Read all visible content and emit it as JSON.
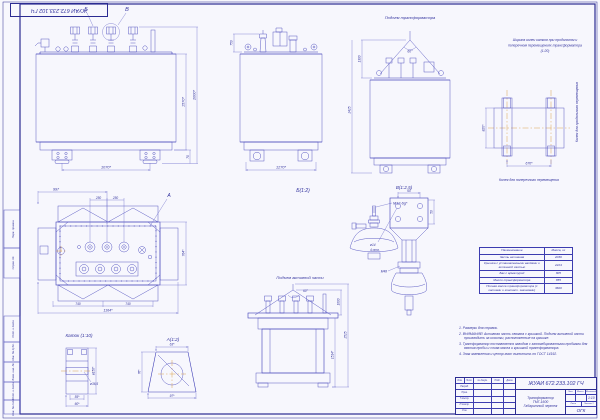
{
  "colors": {
    "paper": "#f7f7fd",
    "line": "#3d3db6",
    "dim_line": "#7070cc",
    "text": "#32329e",
    "center_line": "#d89a3e",
    "frame": "#2b2b92"
  },
  "stamp": {
    "doc_number_top": "ЖУАИ 672.233.102 ГЧ"
  },
  "labels": {
    "marker_b": "Б",
    "marker_v": "В",
    "marker_a": "А",
    "detail_b": "Б(1:2)",
    "detail_v": "В(1:2,5)",
    "detail_a": "А(1:2)",
    "roller": "Каток  (1:10)",
    "lift_transformer": "Подъем трансформатора",
    "lift_active": "Подъем активной части",
    "track_note_1": "Ширина колеи катков при продольном и",
    "track_note_2": "поперечном перемещениях трансформатора",
    "track_note_3": "(1:20)",
    "track_transverse": "Колея для поперечного перемещения",
    "track_longitudinal": "Колея для продольного перемещения"
  },
  "dims": {
    "front_width": "1070*",
    "front_h1": "1570*",
    "front_h2": "2000*",
    "front_base": "70",
    "side_width": "1270*",
    "side_bushing_h": "750",
    "lift_h1": "1300",
    "lift_h2": "2425",
    "lift_angle": "60°",
    "plan_w1": "997",
    "plan_250a": "250",
    "plan_250b": "250",
    "plan_h": "764*",
    "plan_740a": "740",
    "plan_740b": "740",
    "plan_total": "1164*",
    "track_h": "820*",
    "track_w": "670*",
    "roller_d": "ø150*",
    "roller_axle": "ø36,5",
    "roller_w1": "55*",
    "roller_w2": "60*",
    "a_top": "63*",
    "a_side": "76*",
    "a_bottom": "97*",
    "thread": "М12-6g*",
    "v_top": "60",
    "v_side": "50",
    "v_holes_d": "ø14",
    "v_holes_n": "4 отв.",
    "v_thread": "М48",
    "active_h1": "1000",
    "active_h2": "2525",
    "active_h3": "1514*",
    "sling_angle": "60°"
  },
  "mass_table": {
    "col_name": "Наименование",
    "col_mass": "Масса, кг",
    "rows": [
      {
        "name": "Часть активная",
        "mass": "2036"
      },
      {
        "name": "Крышка с установленными вводами и активной частью",
        "mass": "2224"
      },
      {
        "name": "Бак с арматурой",
        "mass": "805"
      },
      {
        "name": "Масло трансформатора",
        "mass": "855"
      },
      {
        "name": "Полная масса трансформатора (с катками и контакт. зажимами)",
        "mass": "3600"
      }
    ]
  },
  "notes": [
    "1. Размеры для справок.",
    "2. ВНИМАНИЕ! Активная часть связана с крышкой. Подъем активной части производить за косынки, расположенные на крышке.",
    "3. Трансформатор поставляется заводом с запломбированными пробками для взятия пробы и слива масла и крышкой трансформатора.",
    "4. Знак заземления и центр масс выполнить по ГОСТ 14192."
  ],
  "title_block": {
    "doc_number": "ЖУАИ 672.233.102 ГЧ",
    "name_line1": "Трансформатор",
    "name_line2": "ТМГ-1600",
    "name_line3": "Габаритный чертеж",
    "header_cells": [
      "Изм.",
      "Лист",
      "№ докум.",
      "Подп.",
      "Дата"
    ],
    "sig_labels": [
      "Разраб.",
      "Пров.",
      "Т.контр.",
      "Н.контр.",
      "Утв."
    ],
    "lit_label": "Лит.",
    "mass_label": "Масса",
    "scale_label": "Масштаб",
    "scale_value": "1:10",
    "sheet_label": "Лист",
    "sheets_label": "Листов 1",
    "org": "ОГК"
  },
  "side_labels": [
    "Перв. примен.",
    "Справ. №",
    "Подп. и дата",
    "Инв. № дубл.",
    "Взам. инв. №",
    "Подп. и дата",
    "Инв. № подл."
  ]
}
